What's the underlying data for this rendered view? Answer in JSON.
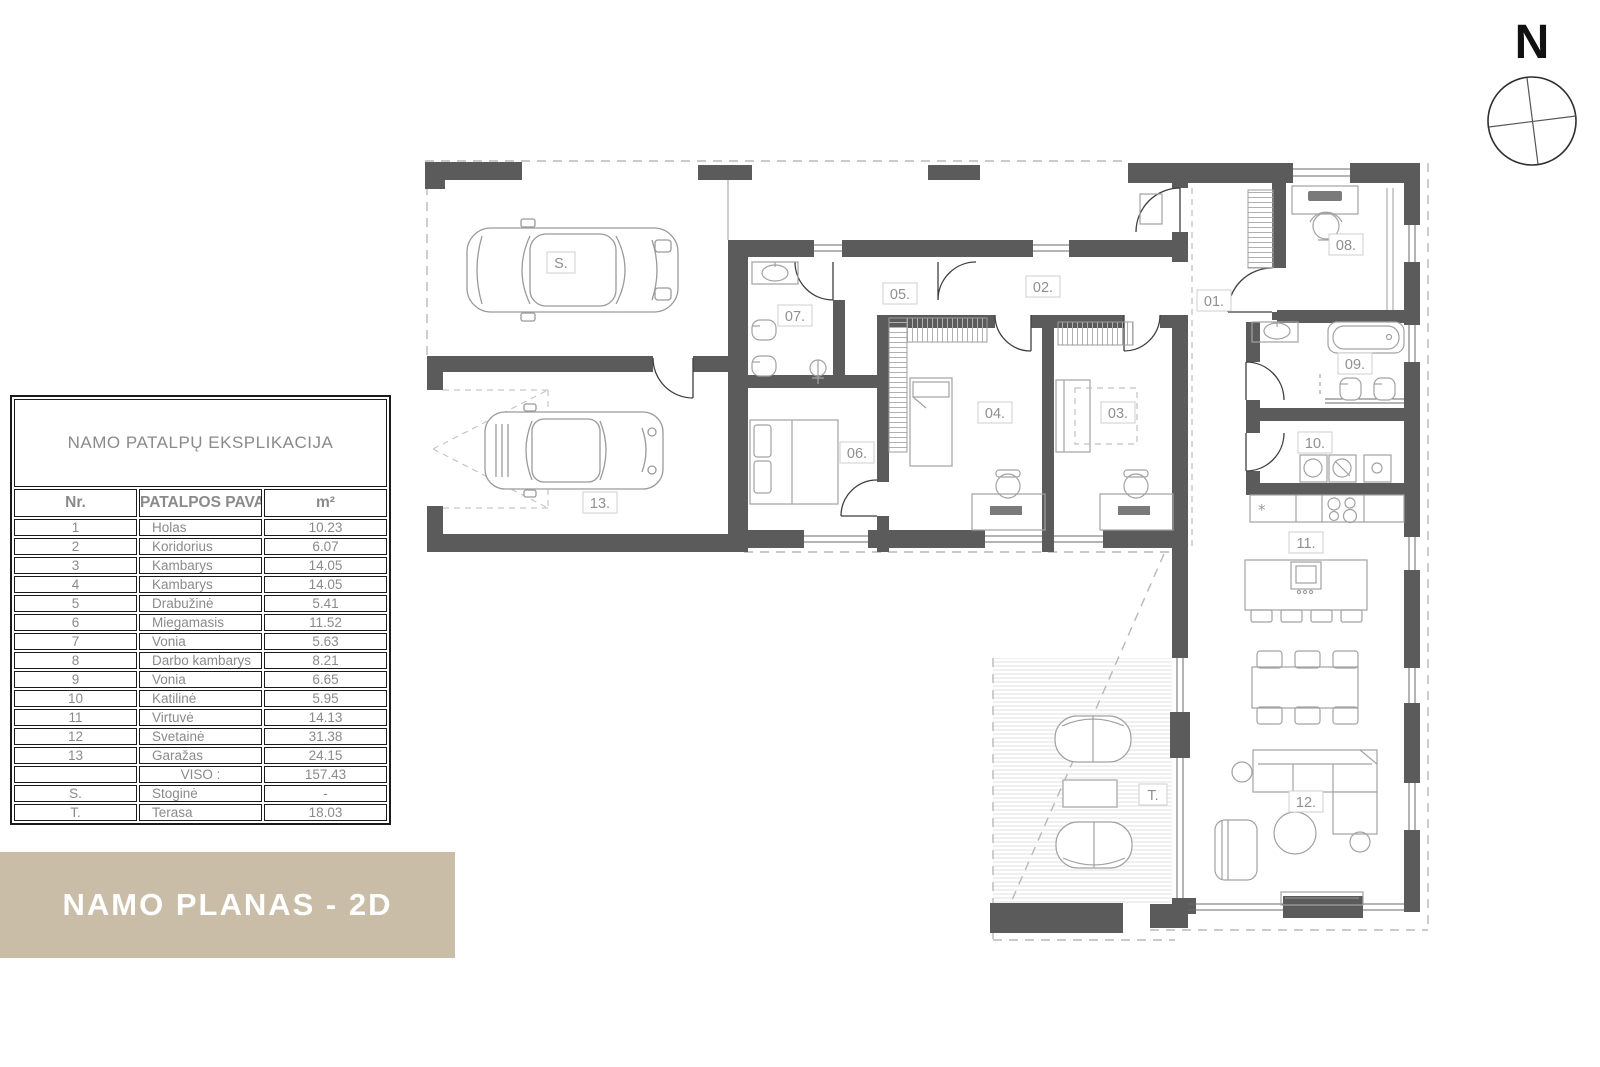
{
  "banner": {
    "text": "NAMO PLANAS - 2D",
    "bg_color": "#c9bda7",
    "text_color": "#ffffff"
  },
  "compass": {
    "label": "N"
  },
  "table": {
    "title": "NAMO PATALPŲ EKSPLIKACIJA",
    "headers": {
      "nr": "Nr.",
      "name": "PATALPOS PAVADINIMAS",
      "area": "m²"
    },
    "rows": [
      {
        "nr": "1",
        "name": "Holas",
        "area": "10.23"
      },
      {
        "nr": "2",
        "name": "Koridorius",
        "area": "6.07"
      },
      {
        "nr": "3",
        "name": "Kambarys",
        "area": "14.05"
      },
      {
        "nr": "4",
        "name": "Kambarys",
        "area": "14.05"
      },
      {
        "nr": "5",
        "name": "Drabužinė",
        "area": "5.41"
      },
      {
        "nr": "6",
        "name": "Miegamasis",
        "area": "11.52"
      },
      {
        "nr": "7",
        "name": "Vonia",
        "area": "5.63"
      },
      {
        "nr": "8",
        "name": "Darbo kambarys",
        "area": "8.21"
      },
      {
        "nr": "9",
        "name": "Vonia",
        "area": "6.65"
      },
      {
        "nr": "10",
        "name": "Katilinė",
        "area": "5.95"
      },
      {
        "nr": "11",
        "name": "Virtuvė",
        "area": "14.13"
      },
      {
        "nr": "12",
        "name": "Svetainė",
        "area": "31.38"
      },
      {
        "nr": "13",
        "name": "Garažas",
        "area": "24.15"
      }
    ],
    "total": {
      "label": "VISO :",
      "area": "157.43"
    },
    "extra_rows": [
      {
        "nr": "S.",
        "name": "Stoginė",
        "area": "-"
      },
      {
        "nr": "T.",
        "name": "Terasa",
        "area": "18.03"
      }
    ]
  },
  "plan": {
    "labels": {
      "s": "S.",
      "r13": "13.",
      "r07": "07.",
      "r05": "05.",
      "r02": "02.",
      "r06": "06.",
      "r04": "04.",
      "r03": "03.",
      "r01": "01.",
      "r08": "08.",
      "r09": "09.",
      "r10": "10.",
      "r11": "11.",
      "r12": "12.",
      "t": "T."
    }
  },
  "colors": {
    "wall": "#5b5b5b",
    "furniture_line": "#a0a0a0",
    "label_text": "#8f8f8f",
    "table_text": "#8a8a8a"
  }
}
